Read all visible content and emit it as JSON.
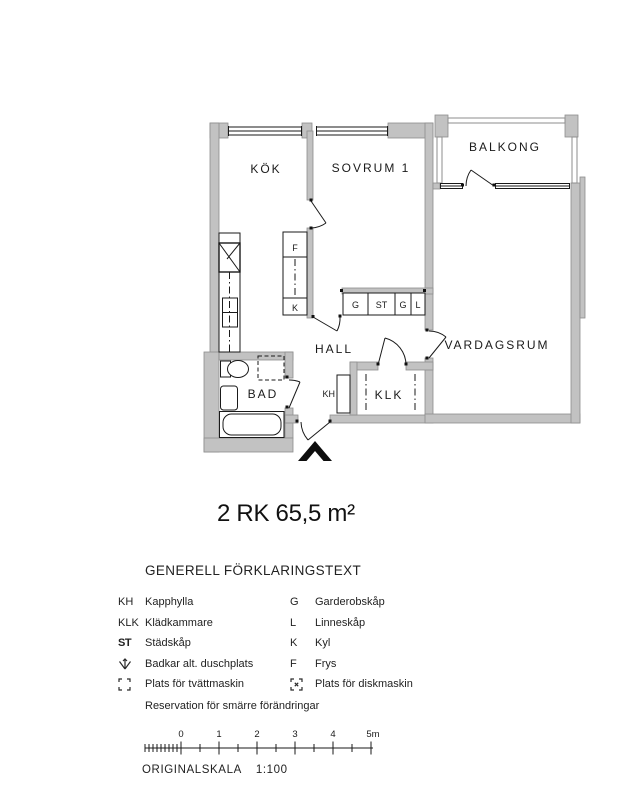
{
  "title": "2 RK 65,5 m²",
  "plan": {
    "rooms": {
      "kok": "KÖK",
      "sovrum": "SOVRUM 1",
      "balkong": "BALKONG",
      "vardagsrum": "VARDAGSRUM",
      "hall": "HALL",
      "bad": "BAD",
      "klk": "KLK"
    },
    "cabinets": {
      "f": "F",
      "k": "K",
      "g1": "G",
      "st": "ST",
      "g2": "G",
      "l": "L",
      "kh": "KH"
    }
  },
  "legend": {
    "header": "GENERELL FÖRKLARINGSTEXT",
    "rows": [
      {
        "left_abbr": "KH",
        "left_label": "Kapphylla",
        "right_abbr": "G",
        "right_label": "Garderobskåp"
      },
      {
        "left_abbr": "KLK",
        "left_label": "Klädkammare",
        "right_abbr": "L",
        "right_label": "Linneskåp"
      },
      {
        "left_abbr": "ST",
        "left_label": "Städskåp",
        "right_abbr": "K",
        "right_label": "Kyl"
      },
      {
        "left_abbr": "",
        "left_label": "Badkar alt. duschplats",
        "right_abbr": "F",
        "right_label": "Frys"
      },
      {
        "left_abbr": "",
        "left_label": "Plats för tvättmaskin",
        "right_abbr": "",
        "right_label": "Plats för diskmaskin"
      }
    ],
    "note": "Reservation för smärre förändringar"
  },
  "scalebar": {
    "tick_labels": [
      "0",
      "1",
      "2",
      "3",
      "4",
      "5m"
    ],
    "caption": "ORIGINALSKALA",
    "ratio": "1:100"
  },
  "colors": {
    "wall_fill": "#c2c2c2",
    "wall_edge": "#8d8d8d",
    "line": "#1a1a1a"
  }
}
